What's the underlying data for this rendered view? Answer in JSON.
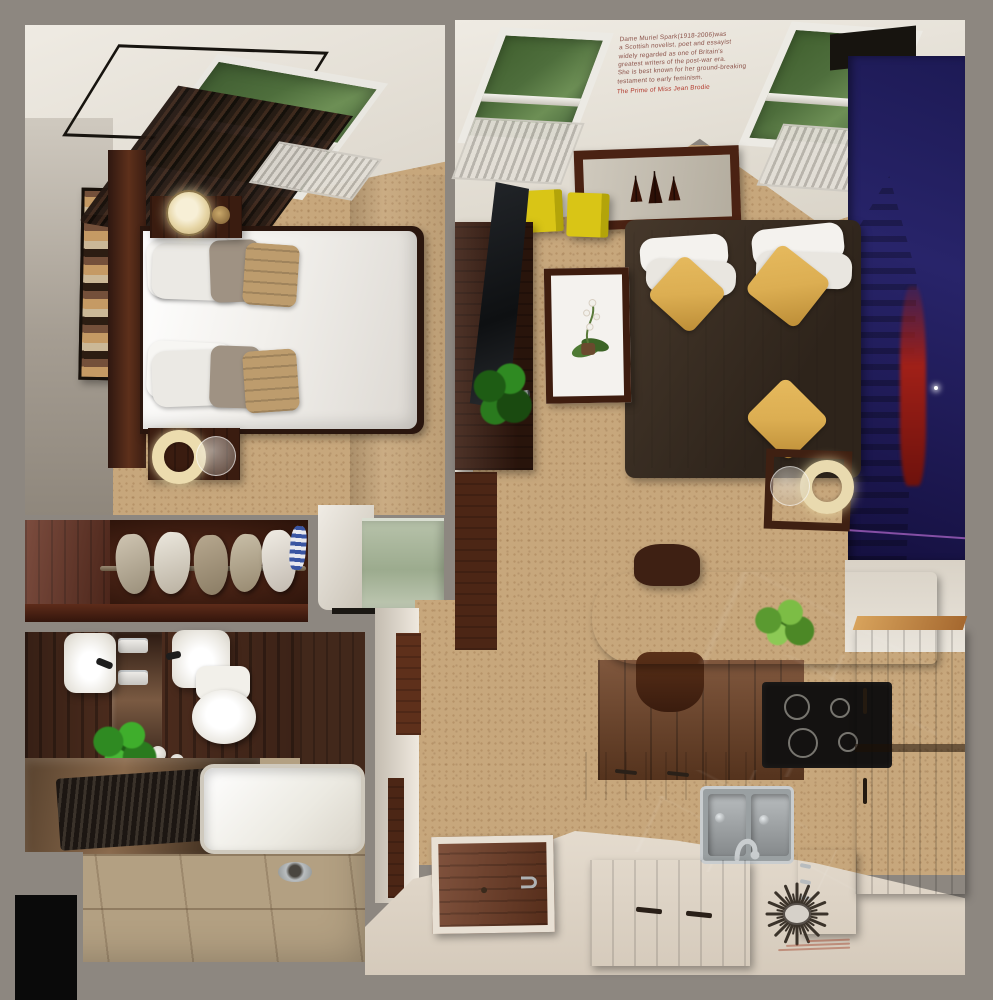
{
  "wall_quote": {
    "lines": [
      "Dame Muriel Spark(1918-2006)was",
      "a Scottish novelist, poet and essayist",
      "widely regarded as one of Britain's",
      "greatest writers of the post-war era.",
      "She is best known for her ground-breaking",
      "testament to early feminism.",
      "The Prime of Miss Jean Brodie"
    ]
  },
  "colors": {
    "bg": "#8d8780",
    "black": "#0a0a0a",
    "carpet": "#c7a77c",
    "cream": "#e9e4db",
    "wall_grey": "#a59d92",
    "ceiling": "#efebe3",
    "wood_dark": "#3a1c10",
    "wood_mid": "#5e301b",
    "wood_red": "#6a3424",
    "oak": "#b06a33",
    "oak_light": "#cf9a55",
    "marble": "#1f1b19",
    "tile": "#b3a082",
    "glass_green": "#9cab8e",
    "foliage": "#4e6e3c",
    "foliage_light": "#6d8f55",
    "plant_green": "#3f7a2f",
    "plant_bright": "#7cbd45",
    "yellow": "#d9c516",
    "yellow_dark": "#b3a40a",
    "gold": "#dcae52",
    "white_soft": "#f4f2ee",
    "taupe": "#9f9283",
    "burlap": "#bd9c6d",
    "mural_sky": "#28246a",
    "mural_sky_dark": "#151040",
    "mural_ruin": "#5c3a22",
    "mural_red": "#a02018",
    "chrome": "#c3c7c9",
    "lamp_cream": "#ecdcae",
    "radiator": "#d9d5cd",
    "text_brown": "#8a5148",
    "text_red": "#b23a2e"
  }
}
